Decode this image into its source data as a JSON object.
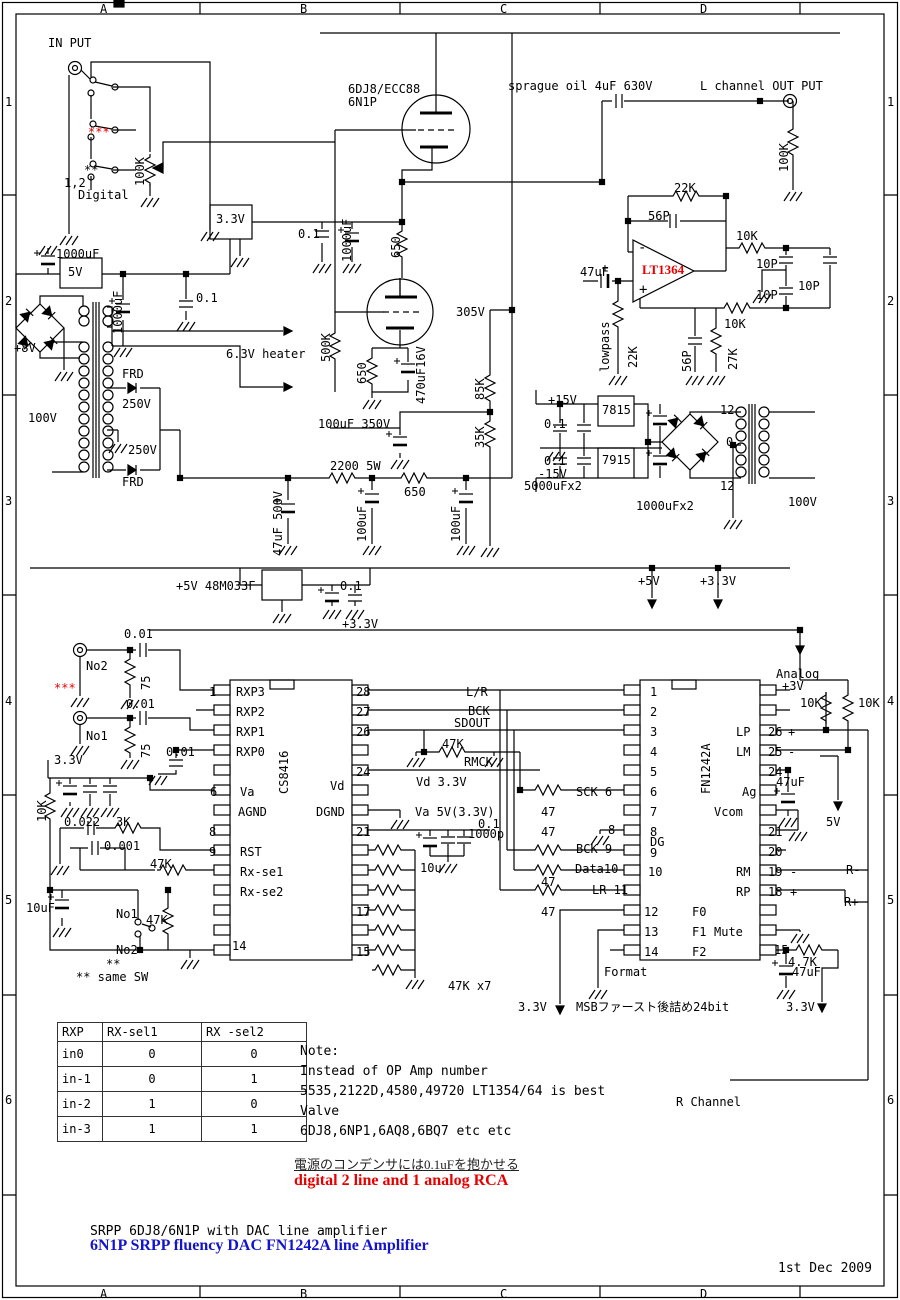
{
  "doc": {
    "title_plain": "SRPP 6DJ8/6N1P with DAC line amplifier",
    "title_blue": "6N1P SRPP fluency DAC FN1242A line Amplifier",
    "date": "1st Dec 2009",
    "jp_power_note": "電源のコンデンサには0.1uFを抱かせる",
    "red_note": "digital 2 line and 1 analog RCA"
  },
  "note_block": {
    "x": 300,
    "y": 1044,
    "line_step": 20,
    "lines": [
      "Note:",
      "Instead of OP Amp number",
      "5535,2122D,4580,49720 LT1354/64 is best",
      "Valve",
      "6DJ8,6NP1,6AQ8,6BQ7 etc etc"
    ]
  },
  "table": {
    "headers": [
      "RXP",
      "RX-sel1",
      "RX -sel2"
    ],
    "rows": [
      [
        "in0",
        "0",
        "0"
      ],
      [
        "in-1",
        "0",
        "1"
      ],
      [
        "in-2",
        "1",
        "0"
      ],
      [
        "in-3",
        "1",
        "1"
      ]
    ]
  },
  "border": {
    "columns": [
      {
        "label": "A",
        "x": 100
      },
      {
        "label": "B",
        "x": 300
      },
      {
        "label": "C",
        "x": 500
      },
      {
        "label": "D",
        "x": 700
      }
    ],
    "rows": [
      {
        "label": "1",
        "y": 95
      },
      {
        "label": "2",
        "y": 294
      },
      {
        "label": "3",
        "y": 494
      },
      {
        "label": "4",
        "y": 694
      },
      {
        "label": "5",
        "y": 893
      },
      {
        "label": "6",
        "y": 1093
      }
    ]
  },
  "colors": {
    "accent_red": "#e80000",
    "accent_blue": "#1414cc",
    "ink": "#000000"
  },
  "labels": [
    {
      "t": "IN PUT",
      "x": 48,
      "y": 37
    },
    {
      "t": "***",
      "x": 88,
      "y": 126,
      "k": "r"
    },
    {
      "t": "**",
      "x": 84,
      "y": 164
    },
    {
      "t": "1,2",
      "x": 64,
      "y": 177
    },
    {
      "t": "Digital",
      "x": 78,
      "y": 189
    },
    {
      "t": "100K",
      "x": 134,
      "y": 186,
      "k": "v"
    },
    {
      "t": "6DJ8/ECC88",
      "x": 348,
      "y": 83
    },
    {
      "t": "6N1P",
      "x": 348,
      "y": 96
    },
    {
      "t": "sprague oil 4uF 630V",
      "x": 508,
      "y": 80
    },
    {
      "t": "L channel OUT PUT",
      "x": 700,
      "y": 80
    },
    {
      "t": "100K",
      "x": 778,
      "y": 172,
      "k": "v"
    },
    {
      "t": "22K",
      "x": 674,
      "y": 182
    },
    {
      "t": "56P",
      "x": 648,
      "y": 210
    },
    {
      "t": "47uF",
      "x": 580,
      "y": 266
    },
    {
      "t": "LT1364",
      "x": 642,
      "y": 264,
      "k": "r sb"
    },
    {
      "t": "-",
      "x": 638,
      "y": 242,
      "k": "big"
    },
    {
      "t": "+",
      "x": 639,
      "y": 284,
      "k": "big"
    },
    {
      "t": "lowpass",
      "x": 599,
      "y": 372,
      "k": "v"
    },
    {
      "t": "22K",
      "x": 627,
      "y": 368,
      "k": "v"
    },
    {
      "t": "10K",
      "x": 736,
      "y": 230
    },
    {
      "t": "10P",
      "x": 756,
      "y": 258
    },
    {
      "t": "10P",
      "x": 756,
      "y": 289
    },
    {
      "t": "10P",
      "x": 798,
      "y": 280
    },
    {
      "t": "10K",
      "x": 724,
      "y": 318
    },
    {
      "t": "56P",
      "x": 681,
      "y": 372,
      "k": "v"
    },
    {
      "t": "27K",
      "x": 727,
      "y": 370,
      "k": "v"
    },
    {
      "t": "3.3V",
      "x": 216,
      "y": 213
    },
    {
      "t": "0.1",
      "x": 298,
      "y": 228
    },
    {
      "t": "1000uF",
      "x": 341,
      "y": 262,
      "k": "v"
    },
    {
      "t": "650",
      "x": 390,
      "y": 258,
      "k": "v"
    },
    {
      "t": "1000uF",
      "x": 56,
      "y": 248
    },
    {
      "t": "5V",
      "x": 68,
      "y": 266
    },
    {
      "t": "1000uF",
      "x": 112,
      "y": 334,
      "k": "v"
    },
    {
      "t": "0.1",
      "x": 196,
      "y": 292
    },
    {
      "t": "+8V",
      "x": 14,
      "y": 342
    },
    {
      "t": "100V",
      "x": 28,
      "y": 412
    },
    {
      "t": "FRD",
      "x": 122,
      "y": 368
    },
    {
      "t": "250V",
      "x": 122,
      "y": 398
    },
    {
      "t": "250V",
      "x": 128,
      "y": 444
    },
    {
      "t": "FRD",
      "x": 122,
      "y": 476
    },
    {
      "t": "6.3V heater",
      "x": 226,
      "y": 348
    },
    {
      "t": "500K",
      "x": 320,
      "y": 362,
      "k": "v"
    },
    {
      "t": "650",
      "x": 356,
      "y": 384,
      "k": "v"
    },
    {
      "t": "470uF16V",
      "x": 415,
      "y": 404,
      "k": "v"
    },
    {
      "t": "305V",
      "x": 456,
      "y": 306
    },
    {
      "t": "85K",
      "x": 474,
      "y": 400,
      "k": "v"
    },
    {
      "t": "35K",
      "x": 474,
      "y": 448,
      "k": "v"
    },
    {
      "t": "100uF 350V",
      "x": 318,
      "y": 418
    },
    {
      "t": "2200 5W",
      "x": 330,
      "y": 460
    },
    {
      "t": "650",
      "x": 404,
      "y": 486
    },
    {
      "t": "100uF",
      "x": 356,
      "y": 542,
      "k": "v"
    },
    {
      "t": "100uF",
      "x": 450,
      "y": 542,
      "k": "v"
    },
    {
      "t": "47uF 500V",
      "x": 272,
      "y": 556,
      "k": "v"
    },
    {
      "t": "+15V",
      "x": 548,
      "y": 394
    },
    {
      "t": "7815",
      "x": 602,
      "y": 404
    },
    {
      "t": "0.1",
      "x": 544,
      "y": 418
    },
    {
      "t": "7915",
      "x": 602,
      "y": 454
    },
    {
      "t": "0.1",
      "x": 544,
      "y": 455
    },
    {
      "t": "-15V",
      "x": 538,
      "y": 468
    },
    {
      "t": "5000uFx2",
      "x": 524,
      "y": 480
    },
    {
      "t": "1000uFx2",
      "x": 636,
      "y": 500
    },
    {
      "t": "12",
      "x": 720,
      "y": 404
    },
    {
      "t": "0",
      "x": 726,
      "y": 436
    },
    {
      "t": "12",
      "x": 720,
      "y": 480
    },
    {
      "t": "100V",
      "x": 788,
      "y": 496
    },
    {
      "t": "+5V",
      "x": 638,
      "y": 575
    },
    {
      "t": "+3.3V",
      "x": 700,
      "y": 575
    },
    {
      "t": "+5V 48M033F",
      "x": 176,
      "y": 580
    },
    {
      "t": "0.1",
      "x": 340,
      "y": 580
    },
    {
      "t": "+3.3V",
      "x": 342,
      "y": 618
    },
    {
      "t": "0.01",
      "x": 124,
      "y": 628
    },
    {
      "t": "No2",
      "x": 86,
      "y": 660
    },
    {
      "t": "75",
      "x": 140,
      "y": 690,
      "k": "v"
    },
    {
      "t": "***",
      "x": 54,
      "y": 682,
      "k": "r"
    },
    {
      "t": "0.01",
      "x": 126,
      "y": 698
    },
    {
      "t": "No1",
      "x": 86,
      "y": 730
    },
    {
      "t": "75",
      "x": 140,
      "y": 758,
      "k": "v"
    },
    {
      "t": "3.3V",
      "x": 54,
      "y": 754
    },
    {
      "t": "0.01",
      "x": 166,
      "y": 746
    },
    {
      "t": "10K",
      "x": 36,
      "y": 822,
      "k": "v"
    },
    {
      "t": "0.022",
      "x": 64,
      "y": 816
    },
    {
      "t": "3K",
      "x": 116,
      "y": 816
    },
    {
      "t": "0.001",
      "x": 104,
      "y": 840
    },
    {
      "t": "47K",
      "x": 150,
      "y": 858
    },
    {
      "t": "10uF",
      "x": 26,
      "y": 902
    },
    {
      "t": "No1",
      "x": 116,
      "y": 908
    },
    {
      "t": "47K",
      "x": 146,
      "y": 914
    },
    {
      "t": "No2",
      "x": 116,
      "y": 944
    },
    {
      "t": "**",
      "x": 106,
      "y": 958
    },
    {
      "t": "** same SW",
      "x": 76,
      "y": 971
    },
    {
      "t": "1",
      "x": 209,
      "y": 686
    },
    {
      "t": "RXP3",
      "x": 236,
      "y": 686
    },
    {
      "t": "RXP2",
      "x": 236,
      "y": 706
    },
    {
      "t": "RXP1",
      "x": 236,
      "y": 726
    },
    {
      "t": "RXP0",
      "x": 236,
      "y": 746
    },
    {
      "t": "CS8416",
      "x": 278,
      "y": 794,
      "k": "v"
    },
    {
      "t": "6",
      "x": 210,
      "y": 786
    },
    {
      "t": "Va",
      "x": 240,
      "y": 786
    },
    {
      "t": "AGND",
      "x": 238,
      "y": 806
    },
    {
      "t": "8",
      "x": 209,
      "y": 826
    },
    {
      "t": "9",
      "x": 209,
      "y": 846
    },
    {
      "t": "RST",
      "x": 240,
      "y": 846
    },
    {
      "t": "Rx-se1",
      "x": 240,
      "y": 866
    },
    {
      "t": "Rx-se2",
      "x": 240,
      "y": 886
    },
    {
      "t": "14",
      "x": 232,
      "y": 940
    },
    {
      "t": "28",
      "x": 356,
      "y": 686
    },
    {
      "t": "27",
      "x": 356,
      "y": 706
    },
    {
      "t": "26",
      "x": 356,
      "y": 726
    },
    {
      "t": "24",
      "x": 356,
      "y": 766
    },
    {
      "t": "Vd",
      "x": 330,
      "y": 780
    },
    {
      "t": "DGND",
      "x": 316,
      "y": 806
    },
    {
      "t": "21",
      "x": 356,
      "y": 826
    },
    {
      "t": "17",
      "x": 356,
      "y": 906
    },
    {
      "t": "15",
      "x": 356,
      "y": 946
    },
    {
      "t": "47K x7",
      "x": 448,
      "y": 980
    },
    {
      "t": "L/R",
      "x": 466,
      "y": 686
    },
    {
      "t": "BCK",
      "x": 468,
      "y": 705
    },
    {
      "t": "SDOUT",
      "x": 454,
      "y": 717
    },
    {
      "t": "47K",
      "x": 442,
      "y": 738
    },
    {
      "t": "RMCK",
      "x": 464,
      "y": 756
    },
    {
      "t": "Vd 3.3V",
      "x": 416,
      "y": 776
    },
    {
      "t": "Va 5V(3.3V)",
      "x": 415,
      "y": 806
    },
    {
      "t": "0.1",
      "x": 478,
      "y": 818
    },
    {
      "t": "1000p",
      "x": 468,
      "y": 828
    },
    {
      "t": "10u",
      "x": 420,
      "y": 862
    },
    {
      "t": "SCK 6",
      "x": 576,
      "y": 786
    },
    {
      "t": "47",
      "x": 541,
      "y": 806
    },
    {
      "t": "47",
      "x": 541,
      "y": 826
    },
    {
      "t": "8",
      "x": 608,
      "y": 824
    },
    {
      "t": "BCK 9",
      "x": 576,
      "y": 843
    },
    {
      "t": "Data10",
      "x": 575,
      "y": 863
    },
    {
      "t": "47",
      "x": 541,
      "y": 876
    },
    {
      "t": "LR 11",
      "x": 592,
      "y": 884
    },
    {
      "t": "47",
      "x": 541,
      "y": 906
    },
    {
      "t": "FN1242A",
      "x": 700,
      "y": 794,
      "k": "v"
    },
    {
      "t": "1",
      "x": 650,
      "y": 686
    },
    {
      "t": "2",
      "x": 650,
      "y": 706
    },
    {
      "t": "3",
      "x": 650,
      "y": 726
    },
    {
      "t": "4",
      "x": 650,
      "y": 746
    },
    {
      "t": "5",
      "x": 650,
      "y": 766
    },
    {
      "t": "6",
      "x": 650,
      "y": 786
    },
    {
      "t": "7",
      "x": 650,
      "y": 806
    },
    {
      "t": "8",
      "x": 650,
      "y": 826
    },
    {
      "t": "DG",
      "x": 650,
      "y": 836
    },
    {
      "t": "9",
      "x": 650,
      "y": 847
    },
    {
      "t": "10",
      "x": 648,
      "y": 866
    },
    {
      "t": "12",
      "x": 644,
      "y": 906
    },
    {
      "t": "F0",
      "x": 692,
      "y": 906
    },
    {
      "t": "13",
      "x": 644,
      "y": 926
    },
    {
      "t": "F1",
      "x": 692,
      "y": 926
    },
    {
      "t": "14",
      "x": 644,
      "y": 946
    },
    {
      "t": "F2",
      "x": 692,
      "y": 946
    },
    {
      "t": "Format",
      "x": 604,
      "y": 966
    },
    {
      "t": "LP",
      "x": 736,
      "y": 726
    },
    {
      "t": "26",
      "x": 768,
      "y": 726
    },
    {
      "t": "+",
      "x": 788,
      "y": 726
    },
    {
      "t": "LM",
      "x": 736,
      "y": 746
    },
    {
      "t": "25",
      "x": 768,
      "y": 746
    },
    {
      "t": "-",
      "x": 788,
      "y": 746
    },
    {
      "t": "24",
      "x": 768,
      "y": 766
    },
    {
      "t": "Ag",
      "x": 742,
      "y": 786
    },
    {
      "t": "Vcom",
      "x": 714,
      "y": 806
    },
    {
      "t": "21",
      "x": 768,
      "y": 826
    },
    {
      "t": "20",
      "x": 768,
      "y": 846
    },
    {
      "t": "RM",
      "x": 736,
      "y": 866
    },
    {
      "t": "19",
      "x": 768,
      "y": 866
    },
    {
      "t": "-",
      "x": 790,
      "y": 866
    },
    {
      "t": "R-",
      "x": 846,
      "y": 864
    },
    {
      "t": "RP",
      "x": 736,
      "y": 886
    },
    {
      "t": "18",
      "x": 768,
      "y": 886
    },
    {
      "t": "+",
      "x": 790,
      "y": 886
    },
    {
      "t": "R+",
      "x": 844,
      "y": 896
    },
    {
      "t": "Mute",
      "x": 714,
      "y": 926
    },
    {
      "t": "15",
      "x": 774,
      "y": 944
    },
    {
      "t": "4.7K",
      "x": 788,
      "y": 956
    },
    {
      "t": "47uF",
      "x": 792,
      "y": 966
    },
    {
      "t": "47uF",
      "x": 776,
      "y": 776
    },
    {
      "t": "5V",
      "x": 826,
      "y": 816
    },
    {
      "t": "Analog",
      "x": 776,
      "y": 668
    },
    {
      "t": "+3V",
      "x": 782,
      "y": 680
    },
    {
      "t": "10K",
      "x": 800,
      "y": 697
    },
    {
      "t": "10K",
      "x": 858,
      "y": 697
    },
    {
      "t": "3.3V",
      "x": 518,
      "y": 1001
    },
    {
      "t": "MSBファースト後詰め24bit",
      "x": 576,
      "y": 1001
    },
    {
      "t": "3.3V",
      "x": 786,
      "y": 1001
    },
    {
      "t": "R Channel",
      "x": 676,
      "y": 1096
    }
  ]
}
